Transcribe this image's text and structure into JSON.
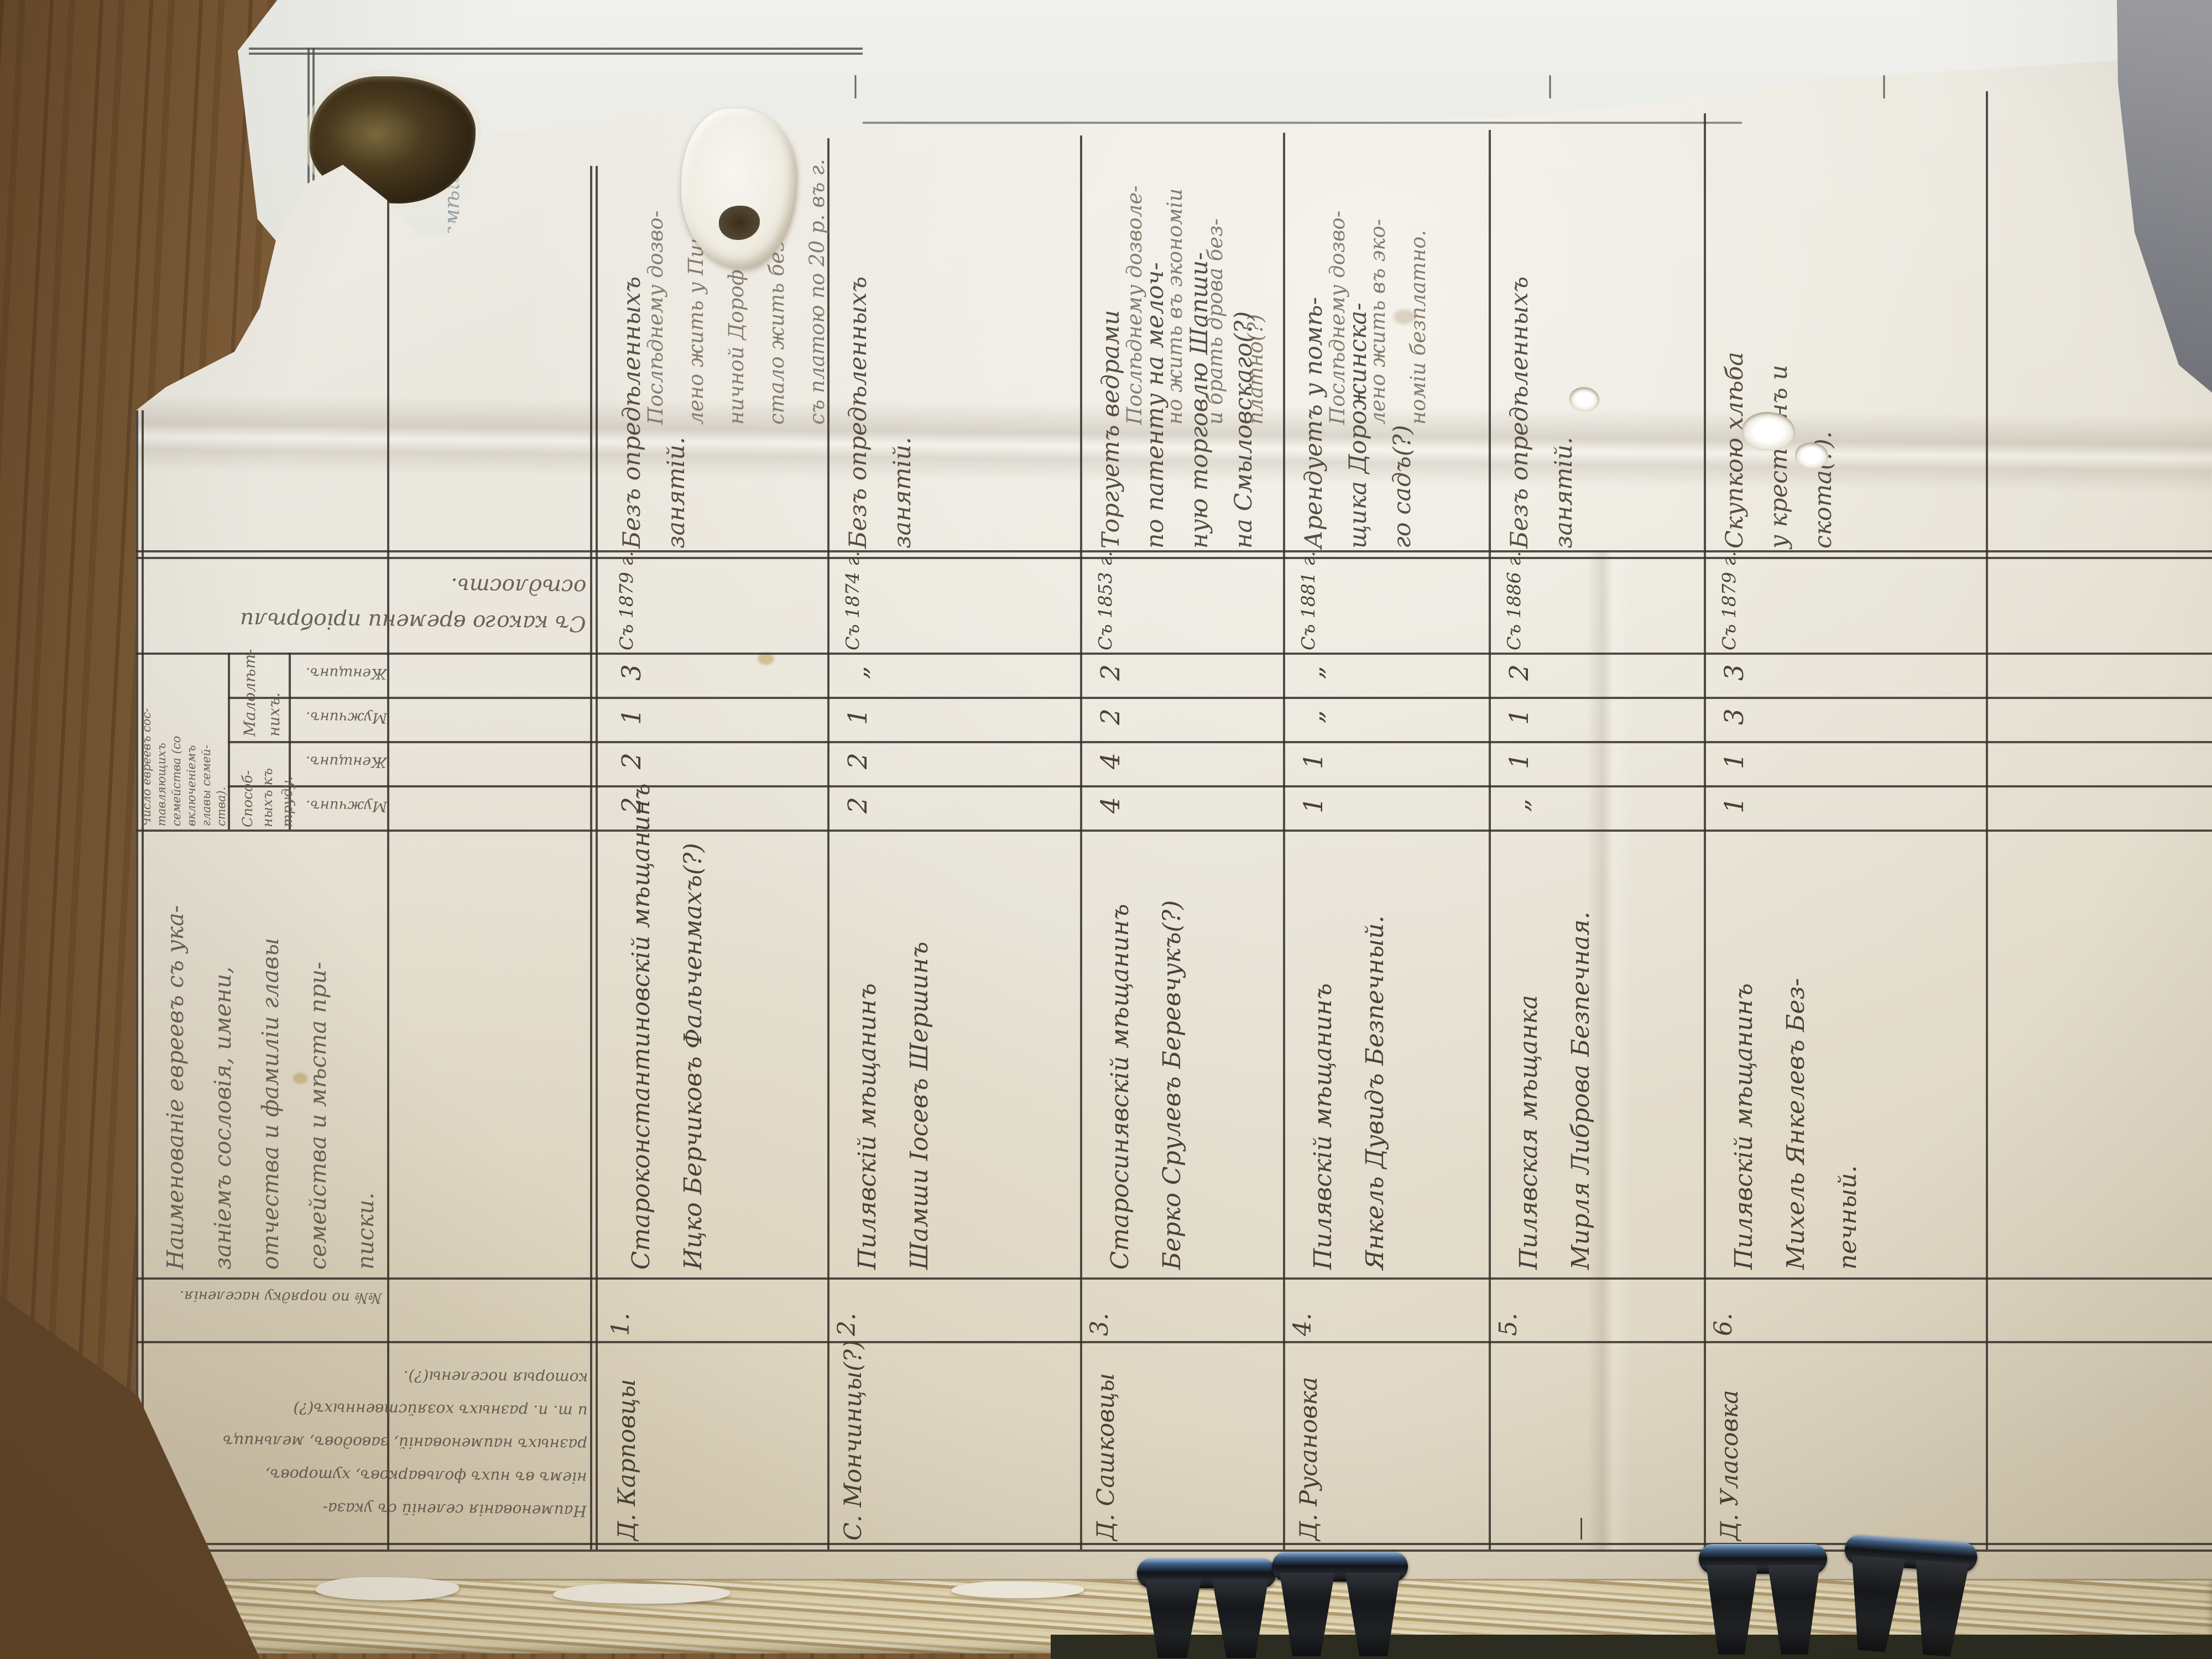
{
  "document": {
    "kind": "Photograph of a handwritten archival ledger page (Russian Empire, pre-reform Cyrillic cursive), page rotated 90 degrees on a wooden table, stack of pages held by black binder clips",
    "legibility": "handwritten cursive, partly torn; transcription approximate"
  },
  "headers": {
    "name_col_lines": [
      "Наименованіе евреевъ съ ука-",
      "заніемъ сословія, имени,",
      "отчества и фамиліи главы",
      "семейства и мѣста при-",
      "писки."
    ],
    "num_col": "№№ по порядку населенія.",
    "since_col_lines": [
      "Съ какого времени пріобрѣли",
      "осѣдлость."
    ],
    "family_count_lines": [
      "Число евреевъ сос-",
      "тавляющихъ",
      "семейства (со",
      "включеніемъ",
      "главы семей-",
      "ства)."
    ],
    "minor_lines": [
      "Малолѣт-",
      "нихъ."
    ],
    "able_lines": [
      "Способ-",
      "ныхъ къ",
      "труду."
    ],
    "row_labels": [
      "Женщинъ.",
      "Мужчинъ.",
      "Женщинъ.",
      "Мужчинъ."
    ],
    "places_col_lines": [
      "Наименованія селеній съ указа-",
      "ніемъ въ нихъ фольварковъ, хуторовъ,",
      "разныхъ наименованій, заводовъ, мельницъ",
      "и т. п. разныхъ хозяйственныхъ(?)",
      "которыя поселены(?)."
    ]
  },
  "entries": [
    {
      "num": "1.",
      "place": "Д. Карповцы",
      "since": "Съ 1879 г.",
      "name_lines": [
        "Староконстантиновскій мѣщанинъ",
        "Ицко Берчиковъ Фальченмахъ(?)"
      ],
      "counts": {
        "able_m": "2",
        "able_f": "2",
        "minor_m": "1",
        "minor_f": "3"
      },
      "occupation_lines": [
        "Безъ опредѣленныхъ",
        "занятій."
      ],
      "note_lines": [
        "Послѣднему дозво-",
        "лено жить у Пше-",
        "ничной Дорофеи(?)",
        "стало жить безъ зем.",
        "съ платою по 20 р. въ г."
      ]
    },
    {
      "num": "2.",
      "place": "С. Мончинцы(?)",
      "since": "Съ 1874 г.",
      "name_lines": [
        "Пилявскій мѣщанинъ",
        "Шамши Іосевъ Шершинъ"
      ],
      "counts": {
        "able_m": "2",
        "able_f": "2",
        "minor_m": "1",
        "minor_f": "„"
      },
      "occupation_lines": [
        "Безъ опредѣленныхъ",
        "занятій."
      ],
      "note_lines": [
        "—"
      ]
    },
    {
      "num": "3.",
      "place": "Д. Сашковцы",
      "since": "Съ 1853 г.",
      "name_lines": [
        "Старосинявскій мѣщанинъ",
        "Берко Срулевъ Беревчукъ(?)"
      ],
      "counts": {
        "able_m": "4",
        "able_f": "4",
        "minor_m": "2",
        "minor_f": "2"
      },
      "occupation_lines": [
        "Торгуетъ ведрами",
        "по патенту на мелоч-",
        "ную торговлю Шапши-",
        "на Смыловскаго(?)"
      ],
      "note_lines": [
        "Послѣднему дозволе-",
        "но жить въ экономіи",
        "и брать дрова без-",
        "платно(?)"
      ]
    },
    {
      "num": "4.",
      "place": "Д. Русановка",
      "since": "Съ 1881 г.",
      "name_lines": [
        "Пилявскій мѣщанинъ",
        "Янкель Дувидъ Безпечный."
      ],
      "counts": {
        "able_m": "1",
        "able_f": "1",
        "minor_m": "„",
        "minor_f": "„"
      },
      "occupation_lines": [
        "Арендуетъ у помѣ-",
        "щика Дорожинска-",
        "го садъ(?)"
      ],
      "note_lines": [
        "Послѣднему дозво-",
        "лено жить въ эко-",
        "номіи безплатно."
      ]
    },
    {
      "num": "5.",
      "place": "—",
      "since": "Съ 1886 г.",
      "name_lines": [
        "Пилявская мѣщанка",
        "Мирля Либрова Безпечная."
      ],
      "counts": {
        "able_m": "„",
        "able_f": "1",
        "minor_m": "1",
        "minor_f": "2"
      },
      "occupation_lines": [
        "Безъ опредѣленныхъ",
        "занятій."
      ],
      "note_lines": [
        "—"
      ]
    },
    {
      "num": "6.",
      "place": "Д. Уласовка",
      "since": "Съ 1879 г.",
      "name_lines": [
        "Пилявскій мѣщанинъ",
        "Михель Янкелевъ Без-",
        "печный."
      ],
      "counts": {
        "able_m": "1",
        "able_f": "1",
        "minor_m": "3",
        "minor_f": "3"
      },
      "occupation_lines": [
        "Скупкою хлѣба",
        "у крестьянъ и",
        "скота(?)."
      ],
      "note_lines": [
        "—"
      ]
    }
  ],
  "underlying_page": {
    "fragments": [
      "вреченія смѣш…",
      "ныхъ Демковъ и",
      "шныхъ и веши…",
      "ея."
    ]
  },
  "colors": {
    "wood": "#7c5b37",
    "paper": "#e9e5d9",
    "under_paper": "#eceeea",
    "stack_edge": "#d3c29a",
    "ink": "#4a4136",
    "pencil": "#847a6c",
    "rule": "#35302a",
    "clip": "#17191c",
    "clip_sheen": "#5e82ad",
    "grey_corner": "#8f9196"
  }
}
